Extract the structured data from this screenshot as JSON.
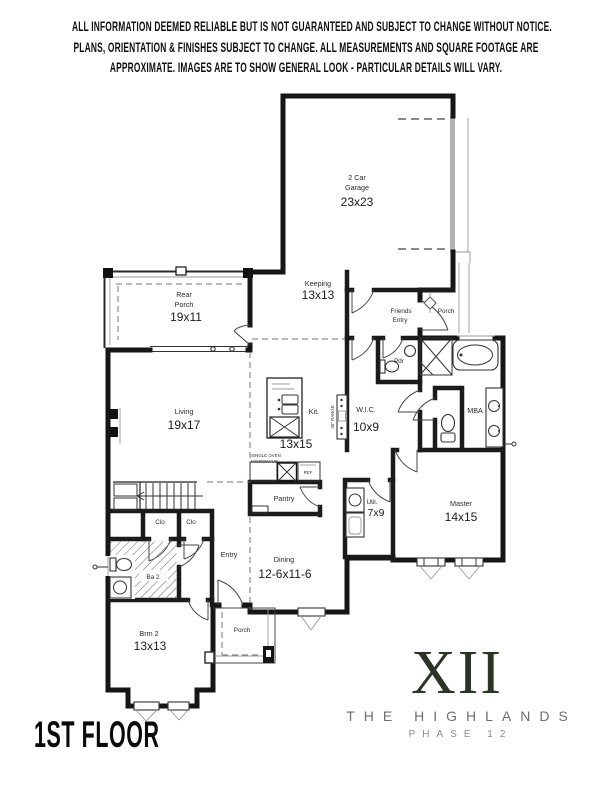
{
  "disclaimer": {
    "line1": "ALL INFORMATION DEEMED RELIABLE BUT IS NOT GUARANTEED AND SUBJECT TO CHANGE WITHOUT NOTICE.",
    "line2": "PLANS, ORIENTATION & FINISHES SUBJECT TO CHANGE. ALL MEASUREMENTS AND SQUARE FOOTAGE ARE",
    "line3": "APPROXIMATE. IMAGES ARE TO SHOW GENERAL LOOK - PARTICULAR DETAILS WILL VARY."
  },
  "footer": {
    "floor_label": "1ST FLOOR"
  },
  "branding": {
    "numeral": "XII",
    "community": "THE HIGHLANDS",
    "phase": "PHASE 12",
    "numeral_color": "#2b3526",
    "community_color": "#6f6f6f",
    "phase_color": "#8c8c8c"
  },
  "plan": {
    "garage_line1": "2 Car",
    "garage_line2": "Garage",
    "garage_dims": "23x23",
    "keeping": "Keeping",
    "keeping_dims": "13x13",
    "rear_porch_line1": "Rear",
    "rear_porch_line2": "Porch",
    "rear_porch_dims": "19x11",
    "friends_line1": "Friends",
    "friends_line2": "Entry",
    "front_porch": "Porch",
    "powder": "Pdr",
    "living": "Living",
    "living_dims": "19x17",
    "kitchen": "Kit.",
    "kitchen_dims": "13x15",
    "range_note": "36\" RANGE",
    "oven_note_line1": "SINGLE OVEN",
    "oven_note_line2": "MICROWAVE",
    "fridge": "REF",
    "wic": "W.I.C.",
    "wic_dims": "10x9",
    "master_bath": "MBA",
    "master": "Master",
    "master_dims": "14x15",
    "utility": "Util.",
    "utility_dims": "7x9",
    "pantry": "Pantry",
    "closet1": "Clo",
    "closet2": "Clo",
    "entry": "Entry",
    "dining": "Dining",
    "dining_dims": "12-6x11-6",
    "bath2": "Ba 2",
    "bedroom2": "Brm 2",
    "bedroom2_dims": "13x13",
    "lower_porch": "Porch"
  }
}
